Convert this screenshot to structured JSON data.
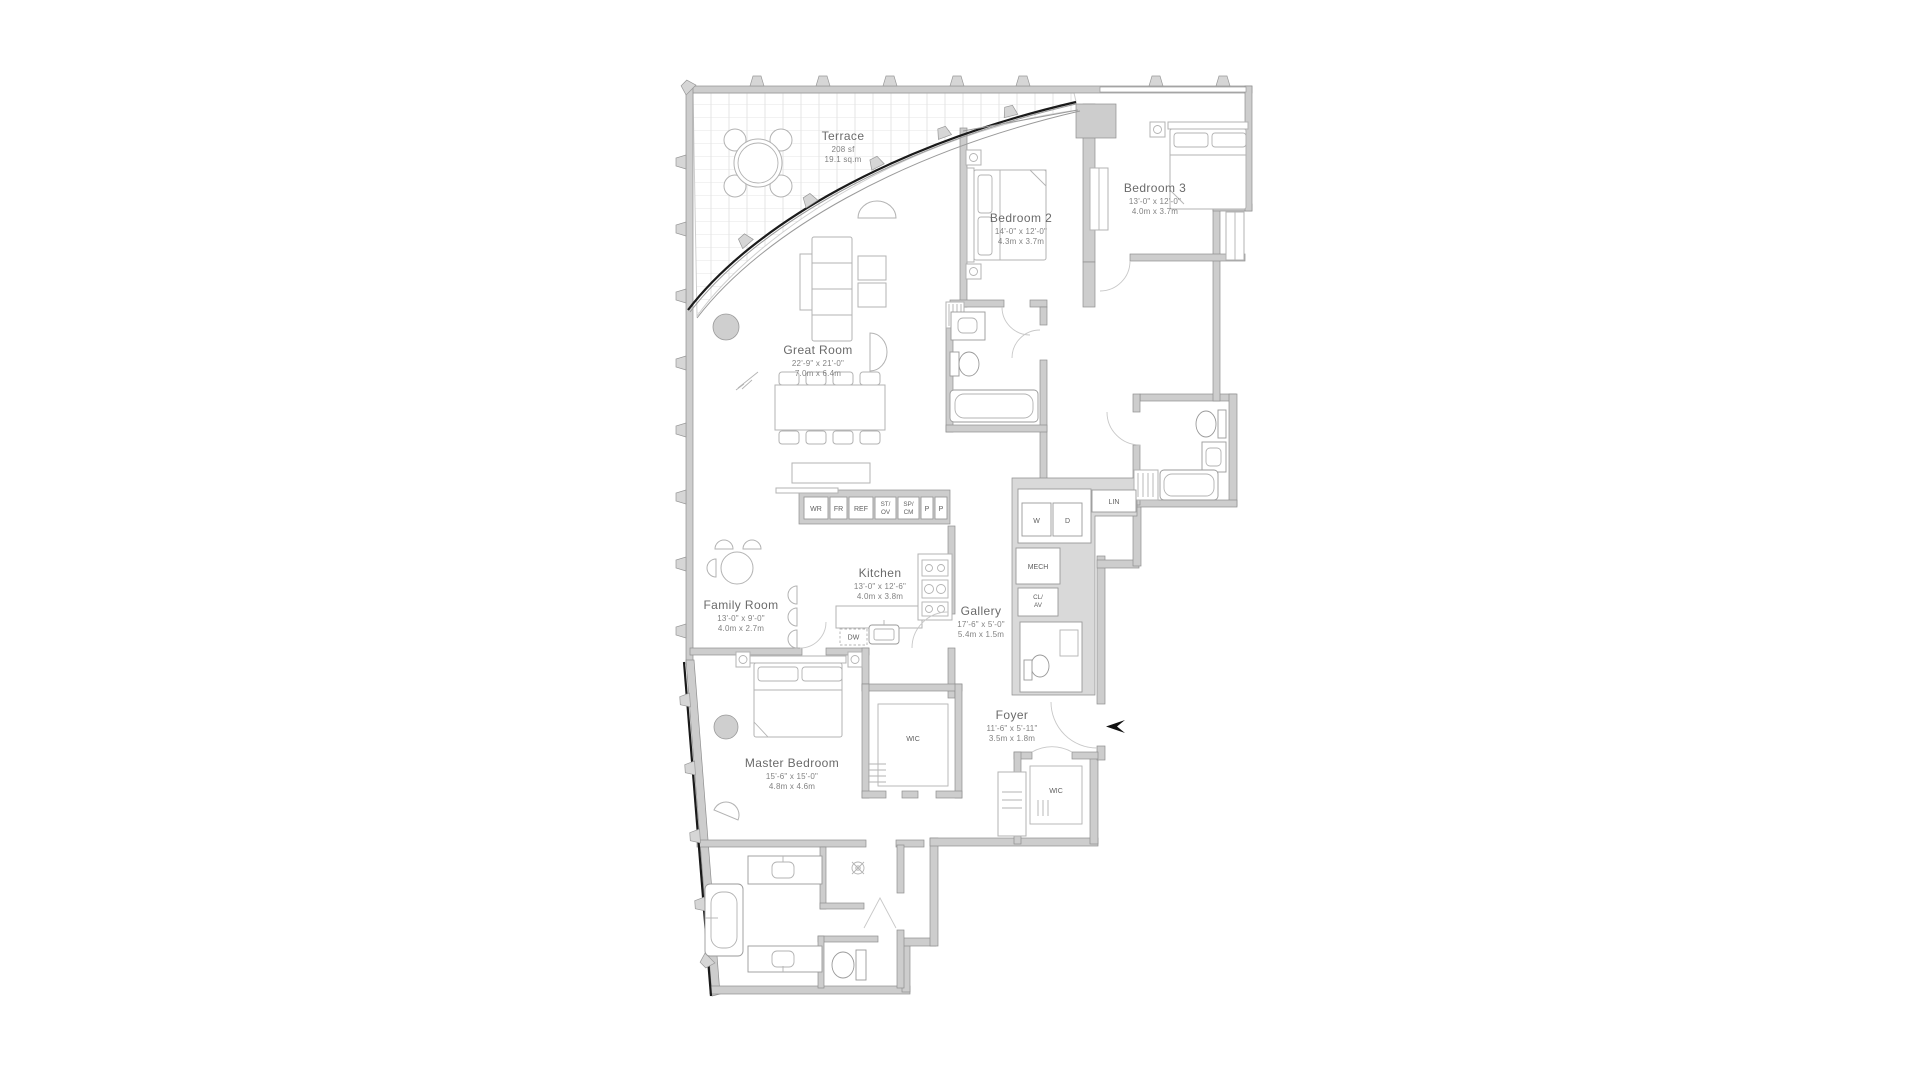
{
  "rooms": [
    {
      "id": "terrace",
      "name": "Terrace",
      "line2": "208 sf",
      "line3": "19.1 sq.m"
    },
    {
      "id": "bedroom-2",
      "name": "Bedroom 2",
      "line2": "14'-0\" x 12'-0\"",
      "line3": "4.3m x 3.7m"
    },
    {
      "id": "bedroom-3",
      "name": "Bedroom 3",
      "line2": "13'-0\" x 12'-0\"",
      "line3": "4.0m x 3.7m"
    },
    {
      "id": "great-room",
      "name": "Great Room",
      "line2": "22'-9\" x 21'-0\"",
      "line3": "7.0m x 6.4m"
    },
    {
      "id": "kitchen",
      "name": "Kitchen",
      "line2": "13'-0\" x 12'-6\"",
      "line3": "4.0m x 3.8m"
    },
    {
      "id": "family-room",
      "name": "Family Room",
      "line2": "13'-0\" x 9'-0\"",
      "line3": "4.0m x 2.7m"
    },
    {
      "id": "gallery",
      "name": "Gallery",
      "line2": "17'-6\" x 5'-0\"",
      "line3": "5.4m x 1.5m"
    },
    {
      "id": "foyer",
      "name": "Foyer",
      "line2": "11'-6\" x 5'-11\"",
      "line3": "3.5m x 1.8m"
    },
    {
      "id": "master-bedroom",
      "name": "Master Bedroom",
      "line2": "15'-6\" x 15'-0\"",
      "line3": "4.8m x 4.6m"
    }
  ],
  "appliances": [
    [
      "WR"
    ],
    [
      "FR"
    ],
    [
      "REF"
    ],
    [
      "ST/",
      "OV"
    ],
    [
      "SP/",
      "CM"
    ],
    [
      "P"
    ],
    [
      "P"
    ]
  ],
  "labels": {
    "washer": "W",
    "dryer": "D",
    "linen": "LIN",
    "mech": "MECH",
    "closet_av": [
      "CL/",
      "AV"
    ],
    "dishwasher": "DW",
    "master_wic": "WIC",
    "foyer_wic": "WIC"
  },
  "colors": {
    "wall": "#cdcdcd",
    "service_zone": "#d9d9d9",
    "glass_accent": "#1a1a1a",
    "text": "#6a6a6a"
  }
}
